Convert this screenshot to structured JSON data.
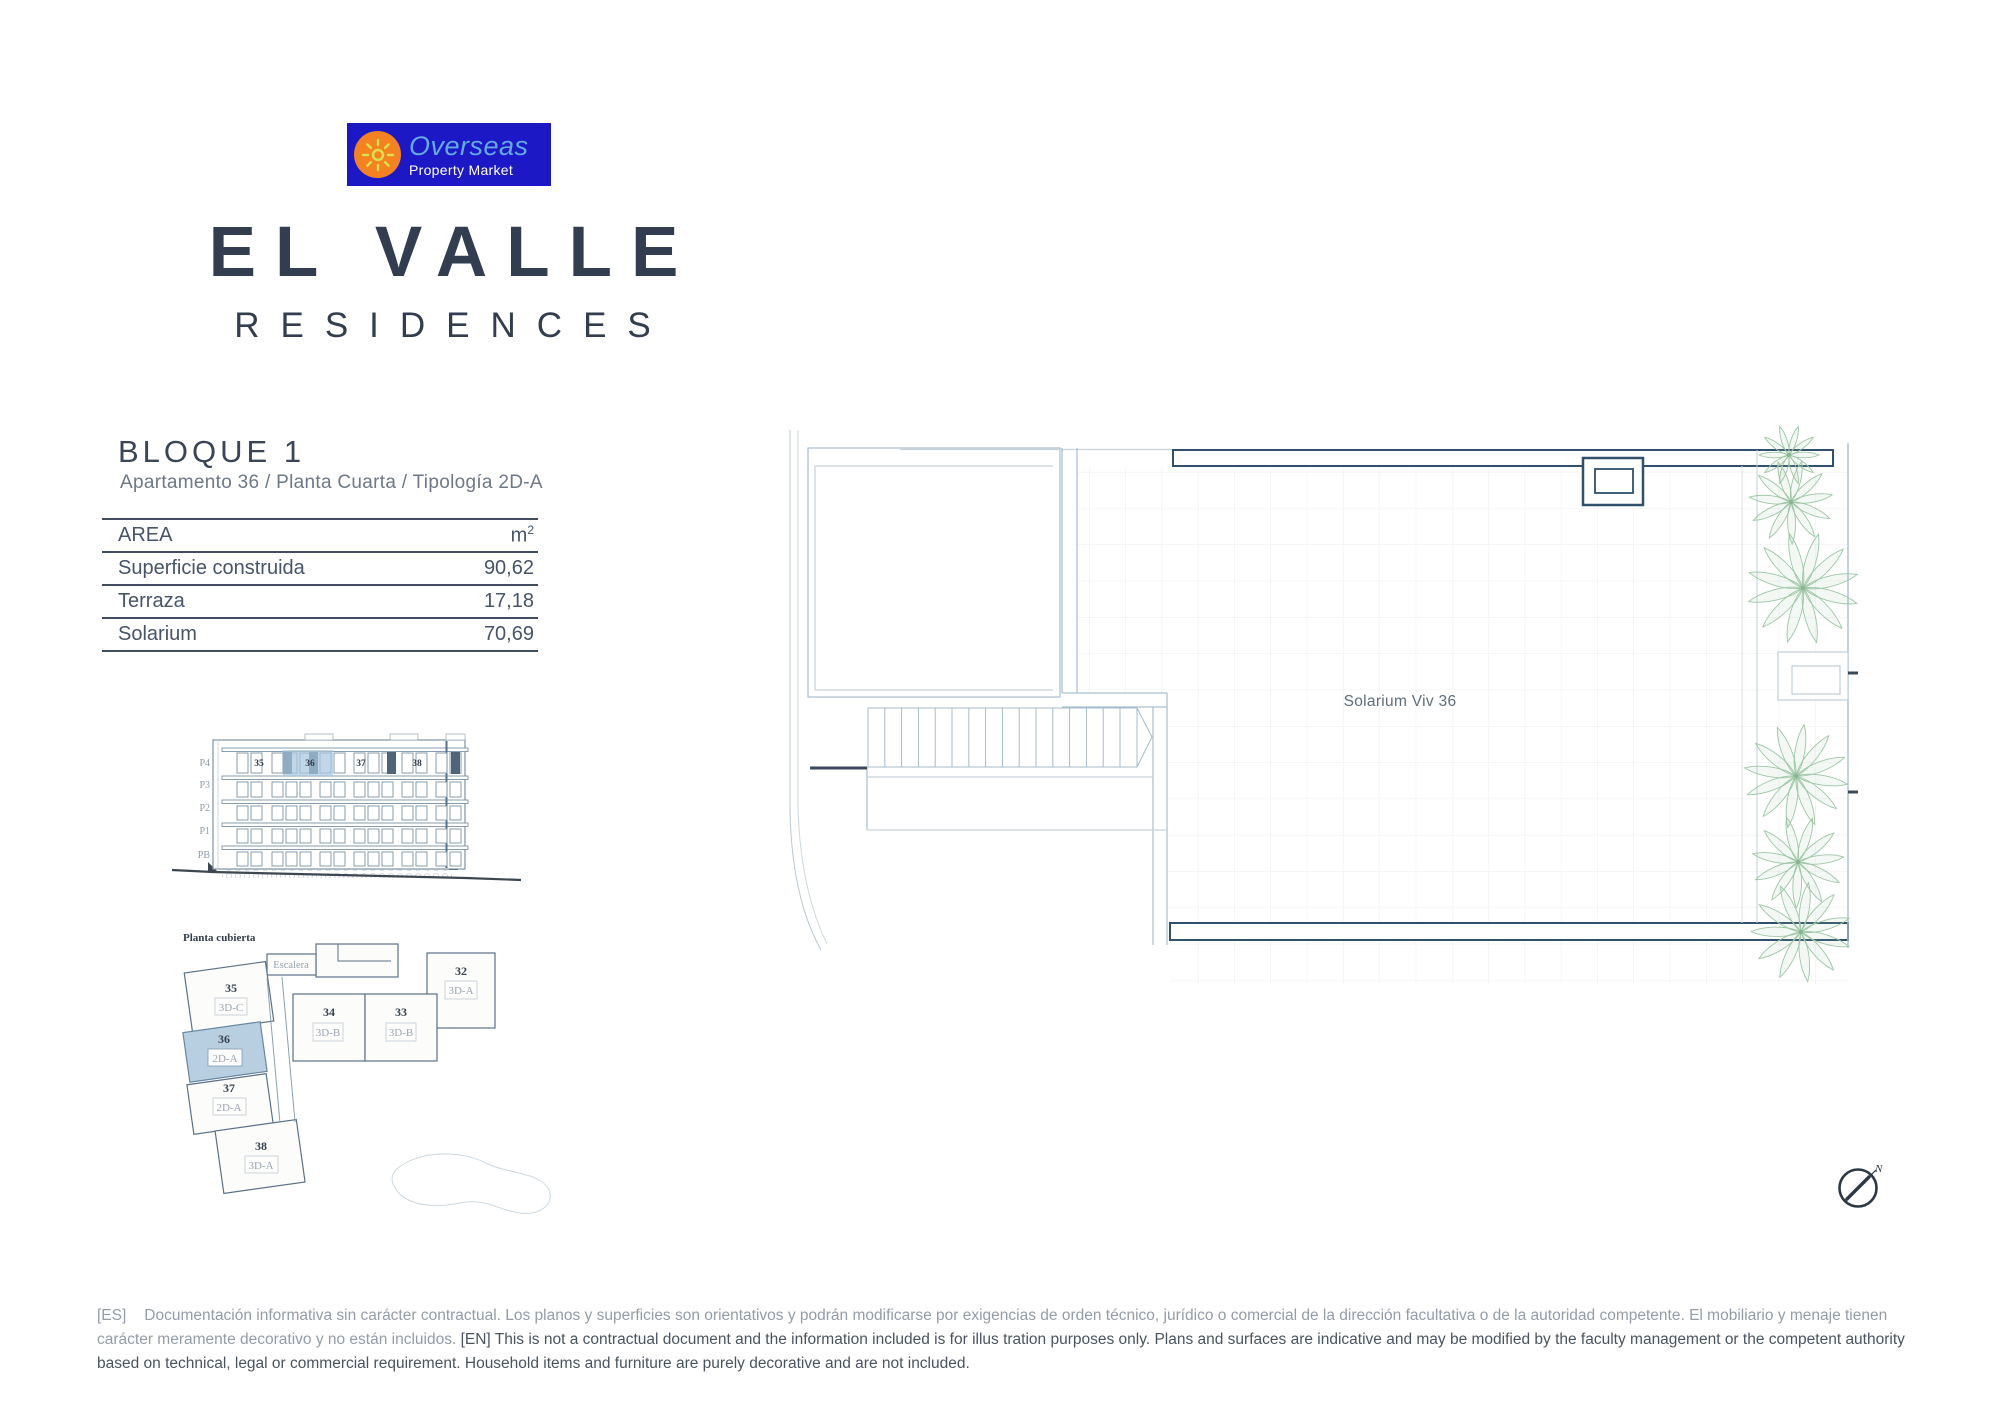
{
  "logo": {
    "name": "Overseas",
    "tagline": "Property Market"
  },
  "brand": {
    "title": "EL VALLE",
    "subtitle": "RESIDENCES"
  },
  "block": {
    "title": "BLOQUE 1",
    "subtitle": "Apartamento 36 / Planta Cuarta / Tipología 2D-A"
  },
  "area_table": {
    "header_label": "AREA",
    "header_unit": "m",
    "header_unit_exp": "2",
    "rows": [
      {
        "label": "Superficie construida",
        "value": "90,62"
      },
      {
        "label": "Terraza",
        "value": "17,18"
      },
      {
        "label": "Solarium",
        "value": "70,69"
      }
    ]
  },
  "elevation": {
    "floor_labels": [
      "P4",
      "P3",
      "P2",
      "P1",
      "PB"
    ],
    "unit_numbers": [
      "35",
      "36",
      "37",
      "38"
    ]
  },
  "key_plan": {
    "title": "Planta cubierta",
    "stairs_label": "Escalera",
    "highlighted_unit": "36",
    "units": [
      {
        "number": "35",
        "type": "3D-C"
      },
      {
        "number": "36",
        "type": "2D-A"
      },
      {
        "number": "37",
        "type": "2D-A"
      },
      {
        "number": "38",
        "type": "3D-A"
      },
      {
        "number": "34",
        "type": "3D-B"
      },
      {
        "number": "33",
        "type": "3D-B"
      },
      {
        "number": "32",
        "type": "3D-A"
      }
    ]
  },
  "main_plan": {
    "room_label": "Solarium Viv 36",
    "compass_label": "N"
  },
  "footer": {
    "es_tag": "[ES]",
    "es_text": "Documentación informativa sin carácter contractual. Los planos y superficies son orientativos y podrán modificarse por exigencias de orden técnico, jurídico o comercial de la dirección facultativa o de la autoridad competente. El mobiliario y menaje tienen carácter meramente decorativo y no están incluidos.",
    "en_tag": "[EN]",
    "en_text": "This is not a contractual document and the information included is for illus tration purposes only. Plans and surfaces are indicative and may be modified by the faculty management or the competent authority based on technical, legal or commercial requirement. Household items and furniture are purely decorative and are not included."
  },
  "colors": {
    "accent_navy": "#31506b",
    "highlight_blue": "#b7cfe0",
    "logo_blue": "#1c18c6",
    "logo_orange": "#f58220",
    "palm_green": "#9dc6a5"
  }
}
